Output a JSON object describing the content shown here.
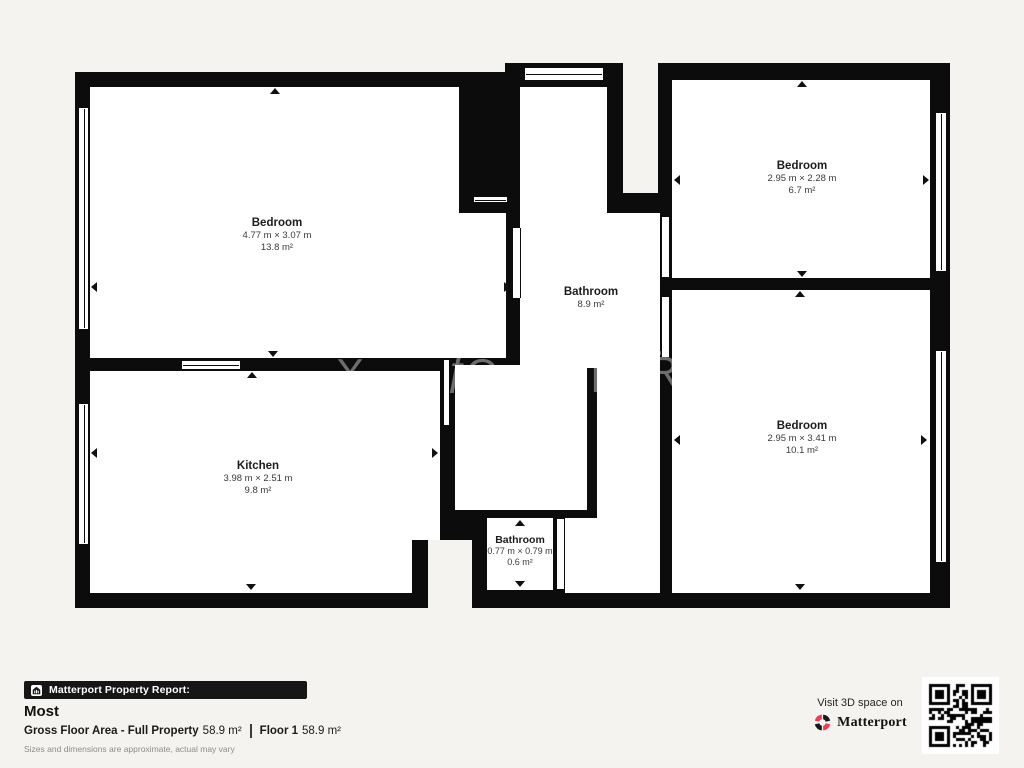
{
  "plan": {
    "rooms": [
      {
        "id": "bedroom-top-left",
        "name": "Bedroom",
        "dimensions": "4.77 m × 3.07 m",
        "area": "13.8 m²"
      },
      {
        "id": "bedroom-top-right",
        "name": "Bedroom",
        "dimensions": "2.95 m × 2.28 m",
        "area": "6.7 m²"
      },
      {
        "id": "bathroom-main",
        "name": "Bathroom",
        "dimensions": "",
        "area": "8.9 m²"
      },
      {
        "id": "kitchen",
        "name": "Kitchen",
        "dimensions": "3.98 m × 2.51 m",
        "area": "9.8 m²"
      },
      {
        "id": "bedroom-bottom-right",
        "name": "Bedroom",
        "dimensions": "2.95 m × 3.41 m",
        "area": "10.1 m²"
      },
      {
        "id": "bathroom-small",
        "name": "Bathroom",
        "dimensions": "0.77 m × 0.79 m",
        "area": "0.6 m²"
      }
    ],
    "watermark_glyphs": [
      "X",
      "ƒ",
      "O",
      "I",
      "Ř"
    ]
  },
  "footer": {
    "banner_label": "Matterport Property Report:",
    "property_name": "Most",
    "gross_area_label": "Gross Floor Area - Full Property",
    "gross_area_value": "58.9 m²",
    "floor_label": "Floor 1",
    "floor_value": "58.9 m²",
    "disclaimer": "Sizes and dimensions are approximate, actual may vary"
  },
  "cta": {
    "visit_text": "Visit 3D space on",
    "brand": "Matterport"
  },
  "colors": {
    "background": "#f5f3f0",
    "wall": "#0c0c0c",
    "room_fill": "#ffffff",
    "banner_bg": "#161616",
    "brand_red": "#f23b57",
    "watermark": "#a9a9a9"
  }
}
